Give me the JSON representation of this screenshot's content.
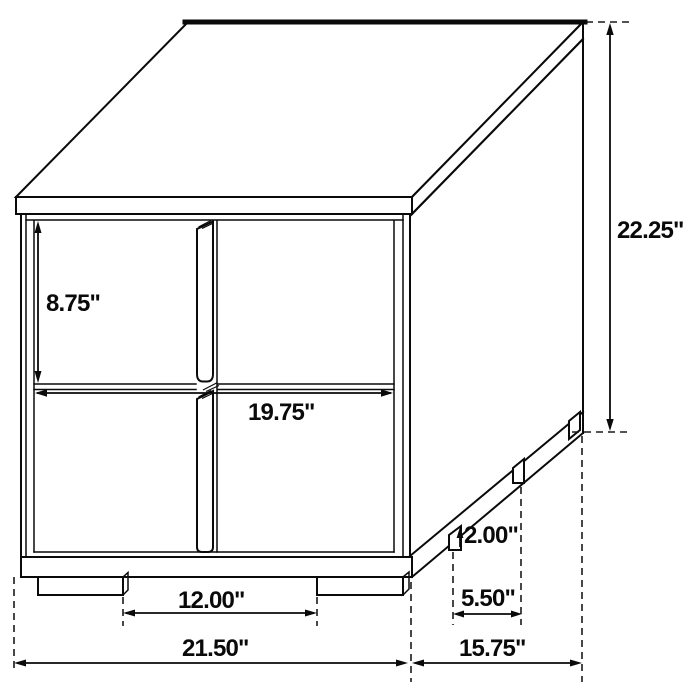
{
  "page": {
    "background_color": "#ffffff",
    "line_color": "#0a0a0a"
  },
  "diagram": {
    "subject": "two-drawer-nightstand-dimension-drawing",
    "labels": {
      "overall_height": "22.25\"",
      "top_drawer_height": "8.75\"",
      "drawer_width": "19.75\"",
      "leg_height": "2.00\"",
      "side_leg_spacing": "5.50\"",
      "front_leg_spacing": "12.00\"",
      "overall_width": "21.50\"",
      "overall_depth": "15.75\""
    }
  }
}
